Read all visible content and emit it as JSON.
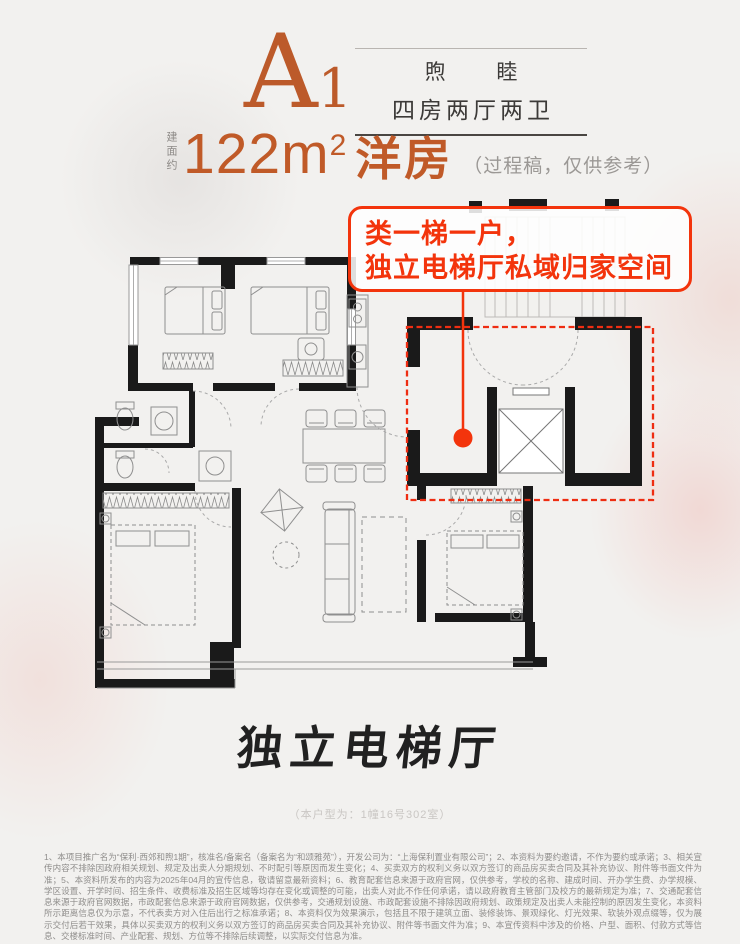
{
  "poster": {
    "header": {
      "unit_letter": "A",
      "unit_number": "1",
      "series_name": "煦 睦",
      "layout_type": "四房两厅两卫"
    },
    "area": {
      "prefix": "建面约",
      "value": "122",
      "unit": "m",
      "superscript": "2",
      "product": "洋房",
      "note": "（过程稿，仅供参考）"
    },
    "floorplan": {
      "annotation_line1": "类一梯一户，",
      "annotation_line2": "独立电梯厅私域归家空间"
    },
    "caption": {
      "title": "独立电梯厅",
      "unit_note": "（本户型为：1幢16号302室）"
    },
    "disclaimer": "1、本项目推广名为“保利·西郊和煦1期”，核准名/备案名（备案名为“和颂雅苑”），开发公司为：“上海保利置业有限公司”；2、本资料为要约邀请，不作为要约或承诺；3、相关宣传内容不排除因政府相关规划、规定及出卖人分期规划、不时配引等原因而发生变化；4、买卖双方的权利义务以双方签订的商品房买卖合同及其补充协议、附件等书面文件为准；5、本资料所发布的内容为2025年04月的宣传信息，敬请留意最新资料；6、教育配套信息来源于政府官网，仅供参考，学校的名称、建成时间、开办学生费、办学规模、学区设置、开学时间、招生条件、收费标准及招生区域等均存在变化或调整的可能，出卖人对此不作任何承诺，请以政府教育主管部门及校方的最新规定为准；7、交通配套信息来源于政府官网数据，市政配套信息来源于政府官网数据，仅供参考，交通规划设施、市政配套设施不排除因政府规划、政策规定及出卖人未能控制的原因发生变化，本资料所示距离信息仅为示意，不代表卖方对入住后出行之标准承诺；8、本资料仅为效果演示，包括且不限于建筑立面、装修装饰、景观绿化、灯光效果、软装外观点缀等，仅为展示交付后若干效果，具体以买卖双方的权利义务以双方签订的商品房买卖合同及其补充协议、附件等书面文件为准；9、本宣传资料中涉及的价格、户型、面积、付款方式等信息、交楼标准时间、产业配套、规划、方位等不排除后续调整，以实际交付信息为准。",
    "colors": {
      "accent_orange": "#bc5a2a",
      "accent_red": "#f3340c",
      "highlight_dash_red": "#ee2d12",
      "wall_black": "#1a1a1a",
      "background": "#f2f1ef"
    }
  }
}
